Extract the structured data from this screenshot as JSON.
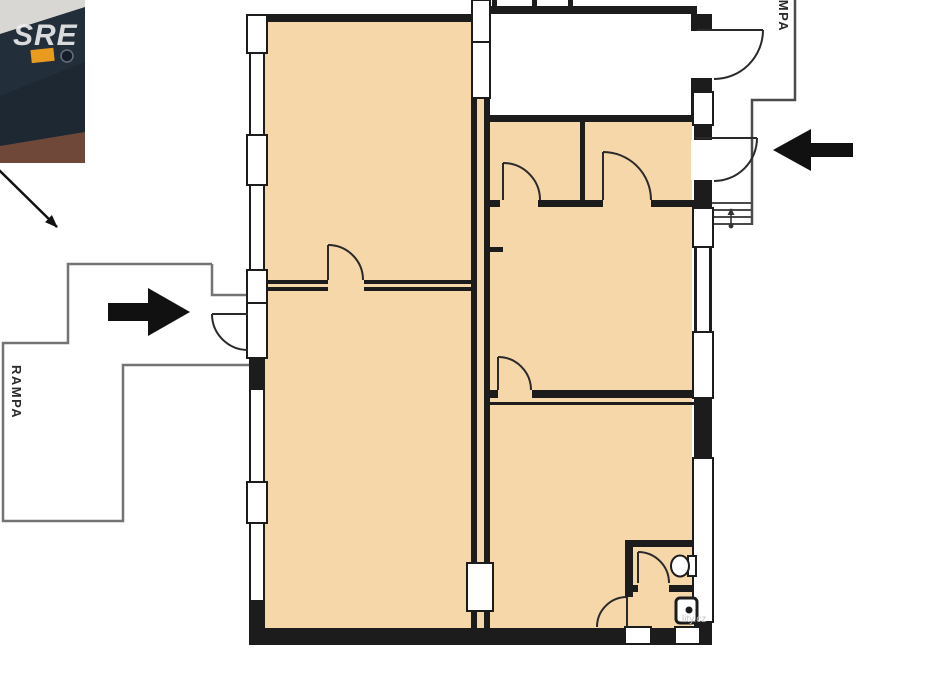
{
  "image": {
    "description": "real-estate floor plan with photo thumbnail and entrance arrows",
    "background": "#ffffff"
  },
  "photo_thumbnail": {
    "watermark": "SRE",
    "colors": {
      "backdrop": "#d8d7d3",
      "body": "#232e3b",
      "body_shadow": "#1e2833",
      "ground": "#70483a",
      "light_patch": "#e89b1c"
    }
  },
  "floor_plan": {
    "room_fill": "#f6d7aa",
    "hall_fill": "#ffffff",
    "wall_color": "#1c1c1c",
    "door_color": "#2a2a2a",
    "ramp_outline_left": "#747474",
    "ramp_outline_right": "#4a4a4a",
    "annotation_arrow_color": "#111111",
    "labels": {
      "ramp_left": "RAMPA",
      "ramp_right": "RAMPA"
    },
    "watermark_fragment": "lity.cz"
  }
}
